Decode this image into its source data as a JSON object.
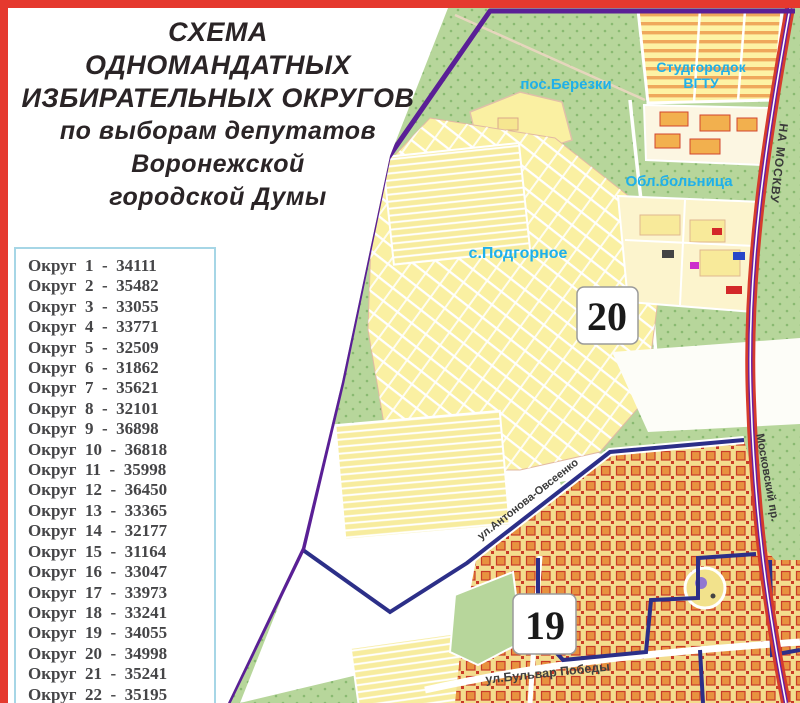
{
  "title": {
    "lines": [
      "СХЕМА",
      "ОДНОМАНДАТНЫХ",
      "ИЗБИРАТЕЛЬНЫХ ОКРУГОВ",
      "по  выборам депутатов",
      "Воронежской",
      "городской  Думы"
    ],
    "color": "#2a2426"
  },
  "legend": {
    "label_prefix": "Округ",
    "separator": "-",
    "rows": [
      {
        "district": 1,
        "voters": 34111
      },
      {
        "district": 2,
        "voters": 35482
      },
      {
        "district": 3,
        "voters": 33055
      },
      {
        "district": 4,
        "voters": 33771
      },
      {
        "district": 5,
        "voters": 32509
      },
      {
        "district": 6,
        "voters": 31862
      },
      {
        "district": 7,
        "voters": 35621
      },
      {
        "district": 8,
        "voters": 32101
      },
      {
        "district": 9,
        "voters": 36898
      },
      {
        "district": 10,
        "voters": 36818
      },
      {
        "district": 11,
        "voters": 35998
      },
      {
        "district": 12,
        "voters": 36450
      },
      {
        "district": 13,
        "voters": 33365
      },
      {
        "district": 14,
        "voters": 32177
      },
      {
        "district": 15,
        "voters": 31164
      },
      {
        "district": 16,
        "voters": 33047
      },
      {
        "district": 17,
        "voters": 33973
      },
      {
        "district": 18,
        "voters": 33241
      },
      {
        "district": 19,
        "voters": 34055
      },
      {
        "district": 20,
        "voters": 34998
      },
      {
        "district": 21,
        "voters": 35241
      },
      {
        "district": 22,
        "voters": 35195
      }
    ],
    "border_color": "#a6d6e6",
    "text_color": "#454547"
  },
  "map": {
    "district_badges": {
      "d20": "20",
      "d19": "19"
    },
    "places": {
      "berezki": "пос.Березки",
      "studgorodok": "Студгородок",
      "vgtu": "ВГТУ",
      "hospital": "Обл.больница",
      "podgornoe": "с.Подгорное"
    },
    "streets": {
      "antonova": "ул.Антонова-Овсеенко",
      "pobedy": "ул.Бульвар Победы",
      "moskovsky": "Московский пр.",
      "na_moskvu": "НА МОСКВУ"
    },
    "colors": {
      "frame_red": "#e5392e",
      "green": "#b7d69b",
      "settlement_yellow": "#faf0a2",
      "urban_orange": "#e8923f",
      "boundary_purple": "#5a1f96",
      "boundary_navy": "#2c2f88",
      "road_red": "#d63c2c",
      "label_cyan": "#1fb0ea"
    }
  }
}
